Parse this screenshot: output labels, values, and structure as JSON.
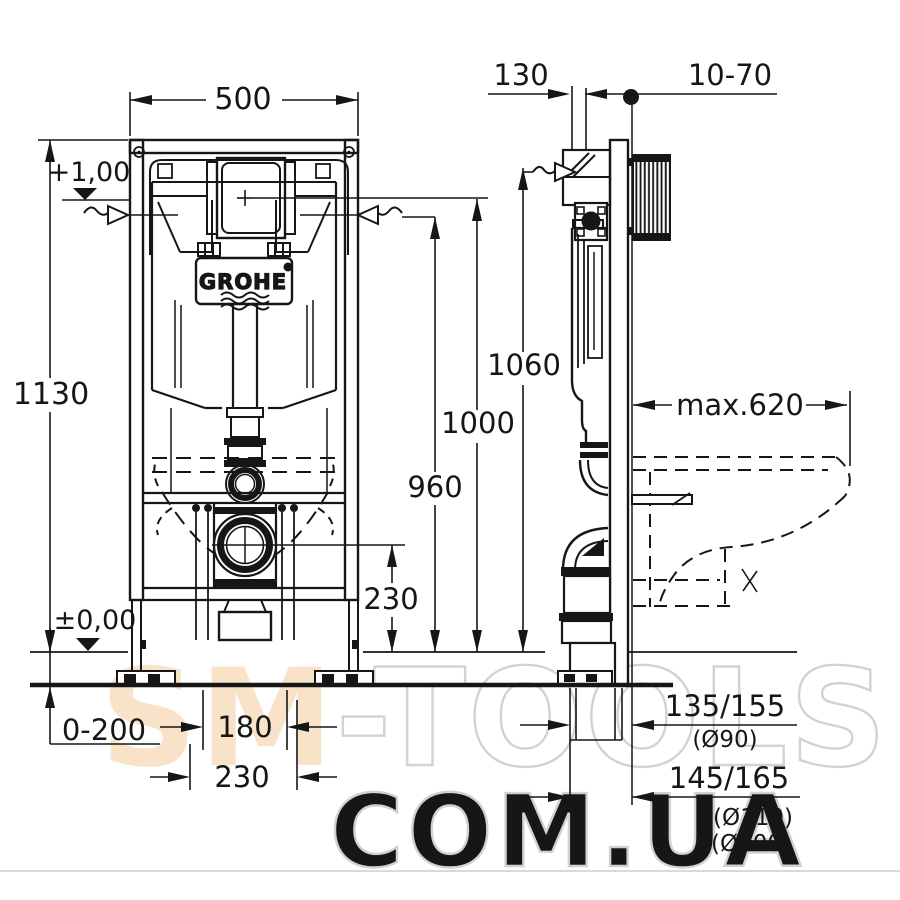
{
  "drawing": {
    "brand": "GROHE",
    "dims": {
      "frame_width": "500",
      "frame_height": "1130",
      "depth": "130",
      "wall_gap": "10-70",
      "h_top": "1060",
      "h_level": "1000",
      "h_water": "960",
      "h_outlet": "230",
      "floor_buildup": "0-200",
      "bolt_span": "180",
      "base_span": "230",
      "bowl_depth": "max.620",
      "level_top": "+1,00",
      "level_floor": "±0,00",
      "drain_a": "135/155",
      "drain_a_d": "(Ø90)",
      "drain_b": "145/165",
      "drain_b_d1": "(Ø110)",
      "drain_b_d2": "(Ø100)"
    }
  },
  "watermark": {
    "part1": "SM",
    "part2": "-TOOLS",
    "line2": "COM.UA",
    "accent_color": "#f8e3c8",
    "outline_color": "#d2d2d2"
  }
}
